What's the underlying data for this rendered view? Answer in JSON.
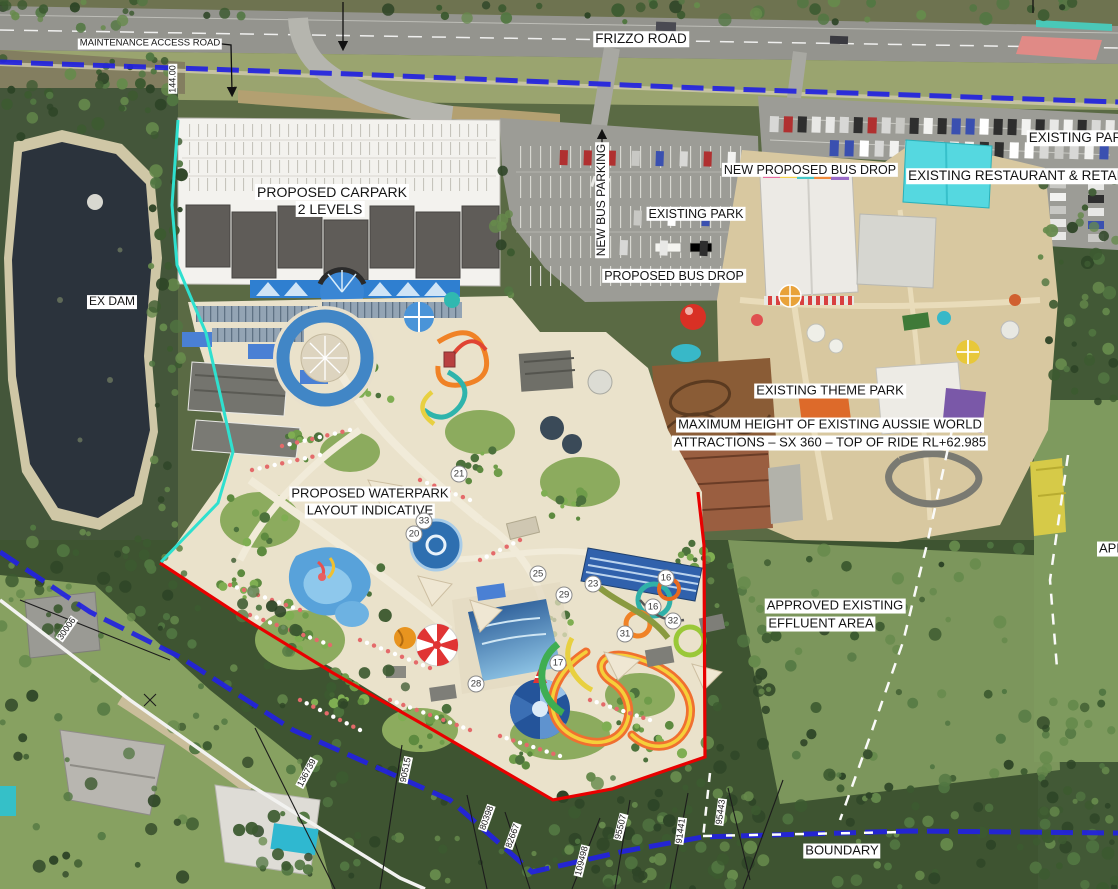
{
  "map": {
    "description": "Aerial masterplan: proposed waterpark and carpark beside existing Aussie World theme park",
    "colors": {
      "cadastral_blue": "#2222e0",
      "boundary_red": "#e80000",
      "site_edge_cyan": "#2fe0cf",
      "survey_white": "#f5f5f2",
      "label_bg": "#ffffff",
      "label_text": "#141414",
      "waterpark_base": "#eae2cb",
      "themepark_base": "#d8c8a0",
      "asphalt": "#9c9c96",
      "dam_water": "#2b333c"
    },
    "place_labels": [
      {
        "id": "maintenance-access-road",
        "text": "MAINTENANCE ACCESS ROAD",
        "x": 150,
        "y": 44,
        "size": 9.5,
        "rot": 0
      },
      {
        "id": "frizzo-road",
        "text": "FRIZZO ROAD",
        "x": 641,
        "y": 39,
        "size": 13.5,
        "rot": 0
      },
      {
        "id": "existing-park-ne",
        "text": "EXISTING PARK",
        "x": 1080,
        "y": 138,
        "size": 13.5,
        "rot": 0
      },
      {
        "id": "existing-restaurant-retail",
        "text": "EXISTING RESTAURANT & RETAIL",
        "x": 1018,
        "y": 176,
        "size": 13.5,
        "rot": 0
      },
      {
        "id": "new-proposed-bus-drop",
        "text": "NEW PROPOSED BUS DROP",
        "x": 810,
        "y": 170,
        "size": 12.5,
        "rot": 0
      },
      {
        "id": "new-bus-parking",
        "text": "NEW BUS PARKING",
        "x": 602,
        "y": 200,
        "size": 12,
        "rot": -90
      },
      {
        "id": "existing-park-mid",
        "text": "EXISTING PARK",
        "x": 696,
        "y": 214,
        "size": 12.5,
        "rot": 0
      },
      {
        "id": "proposed-bus-drop",
        "text": "PROPOSED BUS DROP",
        "x": 674,
        "y": 276,
        "size": 12.5,
        "rot": 0
      },
      {
        "id": "proposed-carpark-line1",
        "text": "PROPOSED CARPARK",
        "x": 332,
        "y": 192,
        "size": 14,
        "rot": 0
      },
      {
        "id": "proposed-carpark-line2",
        "text": "2 LEVELS",
        "x": 330,
        "y": 209,
        "size": 14,
        "rot": 0
      },
      {
        "id": "ex-dam",
        "text": "EX DAM",
        "x": 112,
        "y": 302,
        "size": 12,
        "rot": 0
      },
      {
        "id": "existing-theme-park",
        "text": "EXISTING THEME PARK",
        "x": 830,
        "y": 391,
        "size": 13,
        "rot": 0
      },
      {
        "id": "max-height-line1",
        "text": "MAXIMUM HEIGHT OF EXISTING AUSSIE WORLD",
        "x": 830,
        "y": 425,
        "size": 13,
        "rot": 0
      },
      {
        "id": "max-height-line2",
        "text": "ATTRACTIONS – SX 360 – TOP OF RIDE RL+62.985",
        "x": 830,
        "y": 443,
        "size": 13,
        "rot": 0
      },
      {
        "id": "proposed-waterpark-line1",
        "text": "PROPOSED WATERPARK",
        "x": 370,
        "y": 494,
        "size": 13,
        "rot": 0
      },
      {
        "id": "proposed-waterpark-line2",
        "text": "LAYOUT INDICATIVE",
        "x": 370,
        "y": 511,
        "size": 13,
        "rot": 0
      },
      {
        "id": "approved-effluent-line1",
        "text": "APPROVED EXISTING",
        "x": 835,
        "y": 606,
        "size": 13,
        "rot": 0
      },
      {
        "id": "approved-effluent-line2",
        "text": "EFFLUENT AREA",
        "x": 821,
        "y": 624,
        "size": 13,
        "rot": 0
      },
      {
        "id": "boundary",
        "text": "BOUNDARY",
        "x": 842,
        "y": 851,
        "size": 13,
        "rot": 0
      },
      {
        "id": "approved-clipped-right",
        "text": "APP",
        "x": 1112,
        "y": 549,
        "size": 13,
        "rot": 0
      }
    ],
    "dimension_labels": [
      {
        "text": "144.00",
        "x": 173,
        "y": 79,
        "rot": -90
      },
      {
        "text": "30006",
        "x": 67,
        "y": 629,
        "rot": -55
      },
      {
        "text": "136739",
        "x": 307,
        "y": 773,
        "rot": -62
      },
      {
        "text": "90515",
        "x": 406,
        "y": 770,
        "rot": -78
      },
      {
        "text": "80398",
        "x": 487,
        "y": 818,
        "rot": -70
      },
      {
        "text": "82667",
        "x": 513,
        "y": 836,
        "rot": -70
      },
      {
        "text": "109498",
        "x": 582,
        "y": 861,
        "rot": -76
      },
      {
        "text": "95507",
        "x": 621,
        "y": 827,
        "rot": -76
      },
      {
        "text": "91441",
        "x": 681,
        "y": 831,
        "rot": -82
      },
      {
        "text": "95443",
        "x": 721,
        "y": 812,
        "rot": -82
      }
    ],
    "ride_markers": [
      {
        "n": "21",
        "x": 459,
        "y": 474
      },
      {
        "n": "33",
        "x": 424,
        "y": 521
      },
      {
        "n": "20",
        "x": 414,
        "y": 534
      },
      {
        "n": "25",
        "x": 538,
        "y": 574
      },
      {
        "n": "29",
        "x": 564,
        "y": 595
      },
      {
        "n": "23",
        "x": 593,
        "y": 584
      },
      {
        "n": "16",
        "x": 666,
        "y": 578
      },
      {
        "n": "16",
        "x": 653,
        "y": 607
      },
      {
        "n": "31",
        "x": 625,
        "y": 634
      },
      {
        "n": "32",
        "x": 673,
        "y": 621
      },
      {
        "n": "17",
        "x": 558,
        "y": 663
      },
      {
        "n": "28",
        "x": 476,
        "y": 684
      }
    ]
  }
}
